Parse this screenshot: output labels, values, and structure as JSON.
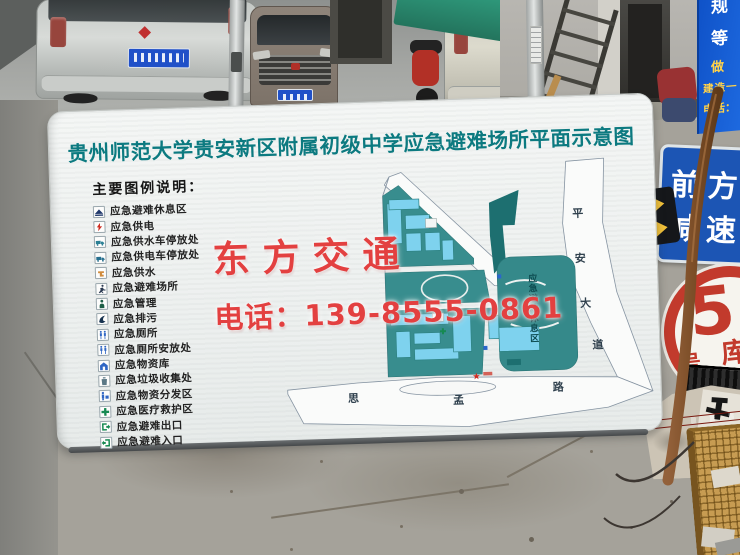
{
  "sign": {
    "title": "贵州师范大学贵安新区附属初级中学应急避难场所平面示意图",
    "title_color": "#0c7a80",
    "legend": {
      "heading": "主要图例说明：",
      "items": [
        {
          "label": "应急避难休息区",
          "icon": "shelter-rest-icon",
          "color": "#20386b"
        },
        {
          "label": "应急供电",
          "icon": "power-supply-icon",
          "color": "#cf2b20"
        },
        {
          "label": "应急供水车停放处",
          "icon": "water-truck-icon",
          "color": "#2a7f94"
        },
        {
          "label": "应急供电车停放处",
          "icon": "power-truck-icon",
          "color": "#27708f"
        },
        {
          "label": "应急供水",
          "icon": "water-supply-icon",
          "color": "#d08b3c"
        },
        {
          "label": "应急避难场所",
          "icon": "shelter-site-icon",
          "color": "#2b3a52"
        },
        {
          "label": "应急管理",
          "icon": "management-icon",
          "color": "#1d5e46"
        },
        {
          "label": "应急排污",
          "icon": "sewage-icon",
          "color": "#16324f"
        },
        {
          "label": "应急厕所",
          "icon": "toilet-icon",
          "color": "#2f66c4"
        },
        {
          "label": "应急厕所安放处",
          "icon": "toilet-place-icon",
          "color": "#2f66c4"
        },
        {
          "label": "应急物资库",
          "icon": "supplies-depot-icon",
          "color": "#2f66c4"
        },
        {
          "label": "应急垃圾收集处",
          "icon": "garbage-icon",
          "color": "#5b7886"
        },
        {
          "label": "应急物资分发区",
          "icon": "supplies-distribution-icon",
          "color": "#2f66c4"
        },
        {
          "label": "应急医疗救护区",
          "icon": "medical-icon",
          "color": "#168a52"
        },
        {
          "label": "应急避难出口",
          "icon": "exit-icon",
          "color": "#168a52"
        },
        {
          "label": "应急避难入口",
          "icon": "entrance-icon",
          "color": "#168a52"
        }
      ]
    },
    "map": {
      "rest_area_chars": [
        "应",
        "急",
        "避",
        "难",
        "休",
        "息",
        "区"
      ],
      "road_right_chars": [
        "平",
        "安",
        "大",
        "道"
      ],
      "road_bottom_chars": [
        "思",
        "孟",
        "路"
      ],
      "marker": "★"
    },
    "watermark": {
      "line1": "东方交通",
      "line2": "电话：139-8555-0861",
      "color": "#e34040"
    }
  },
  "scene": {
    "ad_sign": {
      "char1": "规",
      "char2": "等",
      "char3": "做",
      "char4": "建造一",
      "char5": "电话："
    },
    "traffic_sign": {
      "line1": "前方",
      "line2": "减速"
    },
    "warehouse_sign": {
      "number": "5",
      "left": "号",
      "right": "库"
    }
  }
}
